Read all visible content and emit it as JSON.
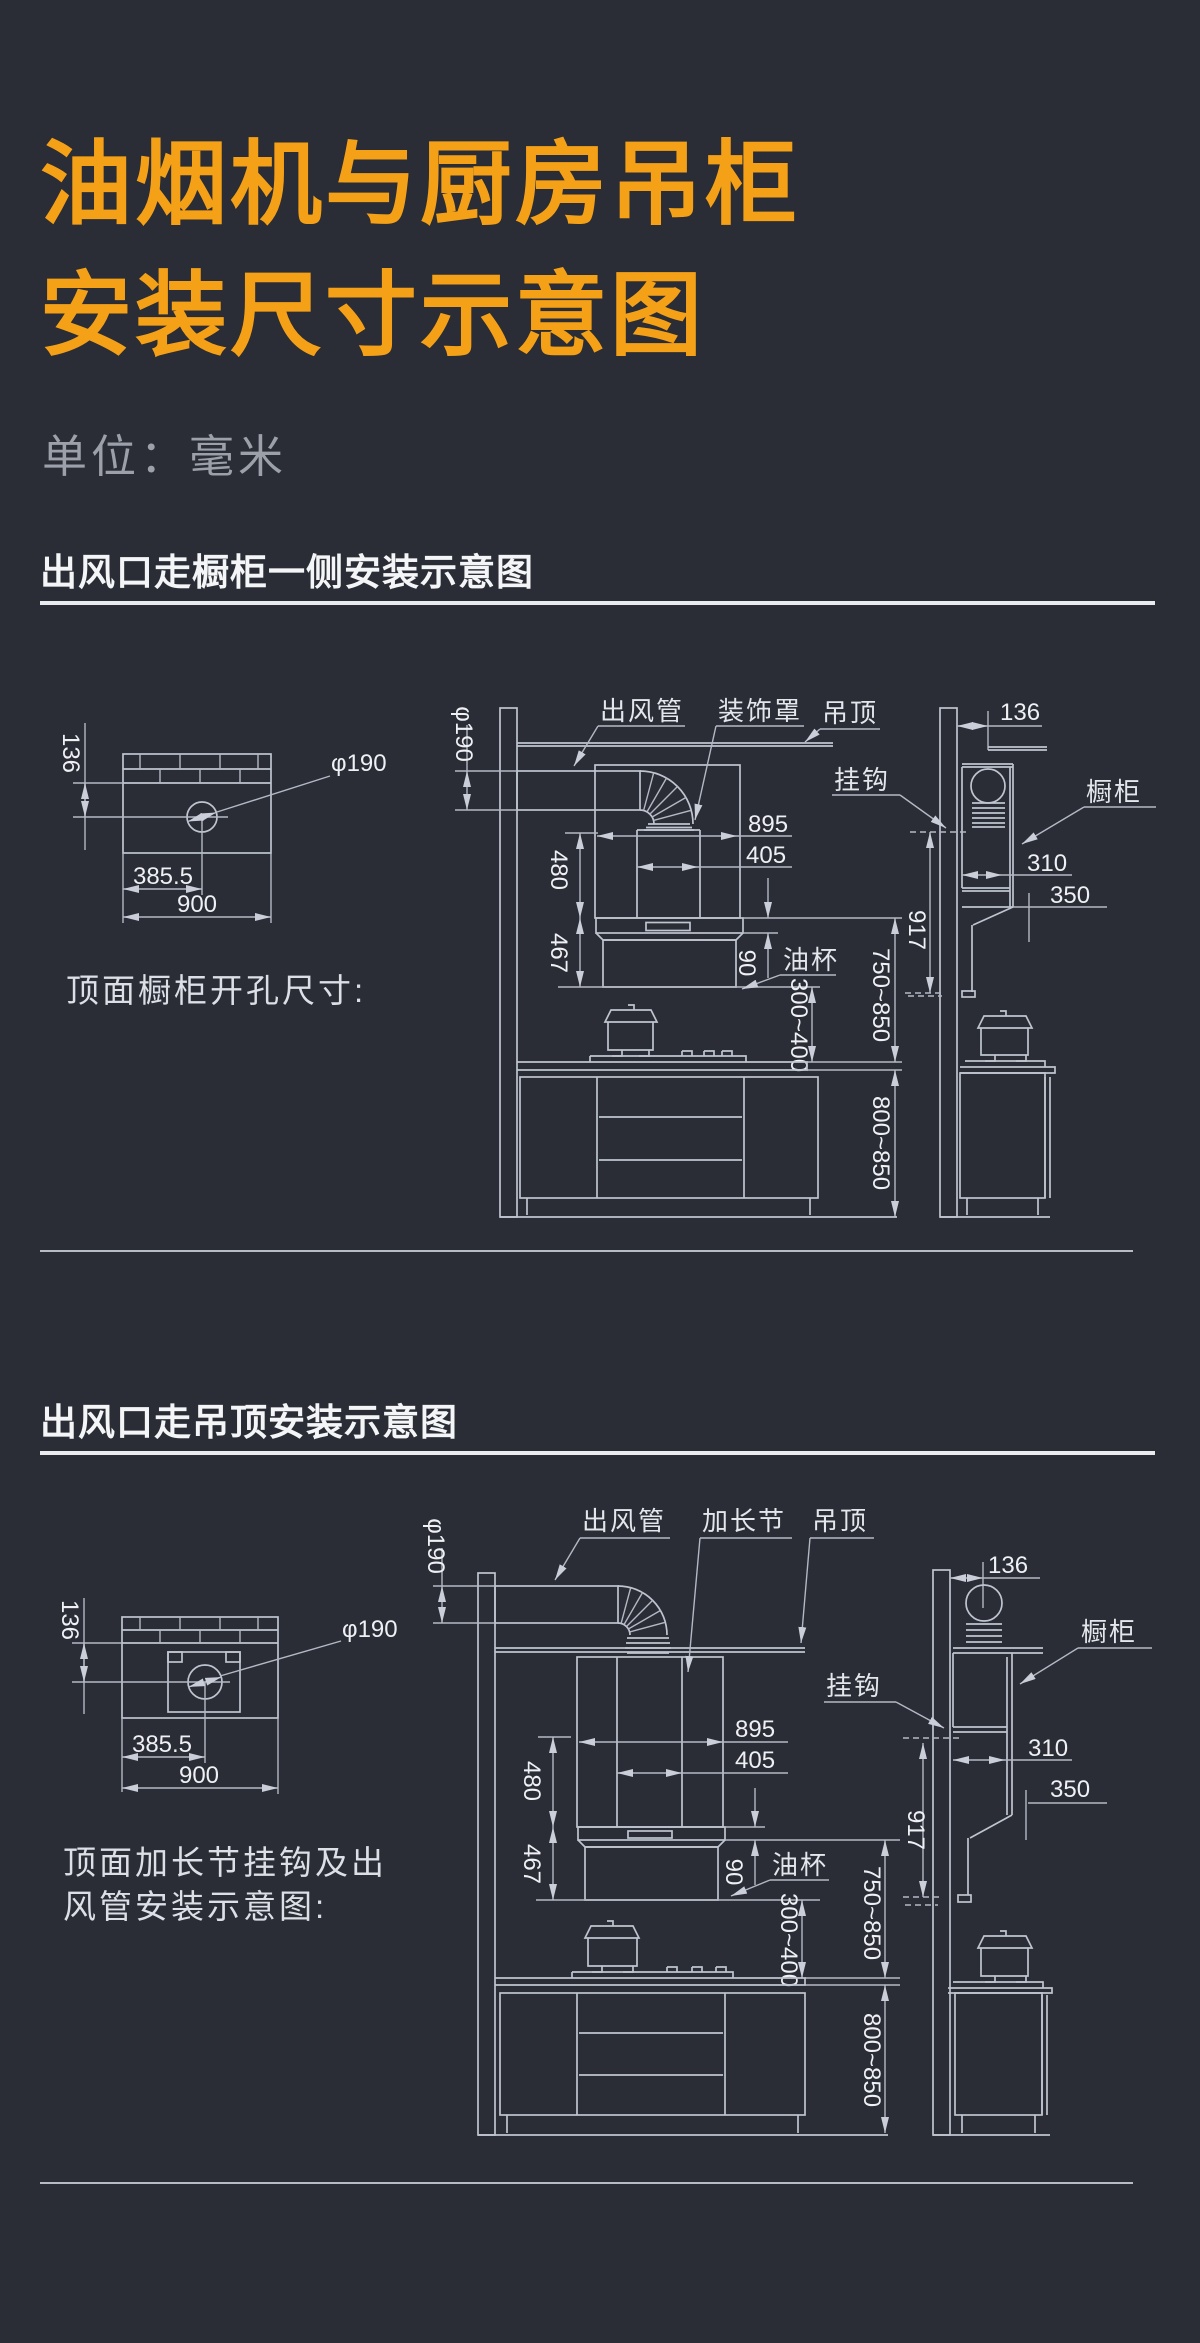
{
  "page": {
    "background": "#2a2c36",
    "accent_color": "#f5a117",
    "line_color": "#bfc5cf"
  },
  "header": {
    "title_line1": "油烟机与厨房吊柜",
    "title_line2": "安装尺寸示意图",
    "subtitle": "单位：毫米"
  },
  "section1": {
    "heading": "出风口走橱柜一侧安装示意图",
    "caption": "顶面橱柜开孔尺寸:",
    "labels": {
      "duct": "出风管",
      "cover": "装饰罩",
      "ceiling": "吊顶",
      "hook": "挂钩",
      "cabinet": "橱柜",
      "oil_cup": "油杯"
    },
    "dims": {
      "hole_offset": "136",
      "hole_dia": "φ190",
      "hole_x": "385.5",
      "cabinet_top_width": "900",
      "duct_dia": "φ190",
      "hood_width": "895",
      "chimney_width": "405",
      "upper_height": "480",
      "lower_height": "467",
      "oilcup_height": "90",
      "pot_clearance": "300~400",
      "hood_to_counter": "750~850",
      "counter_height": "800~850",
      "hook_height": "917",
      "wall_to_duct": "136",
      "cabinet_depth": "310",
      "hood_depth": "350"
    }
  },
  "section2": {
    "heading": "出风口走吊顶安装示意图",
    "caption_line1": "顶面加长节挂钩及出",
    "caption_line2": "风管安装示意图:",
    "labels": {
      "duct": "出风管",
      "extension": "加长节",
      "ceiling": "吊顶",
      "hook": "挂钩",
      "cabinet": "橱柜",
      "oil_cup": "油杯"
    },
    "dims": {
      "hole_offset": "136",
      "hole_dia": "φ190",
      "hole_x": "385.5",
      "cabinet_top_width": "900",
      "duct_dia": "φ190",
      "hood_width": "895",
      "chimney_width": "405",
      "upper_height": "480",
      "lower_height": "467",
      "oilcup_height": "90",
      "pot_clearance": "300~400",
      "hood_to_counter": "750~850",
      "counter_height": "800~850",
      "hook_height": "917",
      "wall_to_duct": "136",
      "cabinet_depth": "310",
      "hood_depth": "350"
    }
  }
}
